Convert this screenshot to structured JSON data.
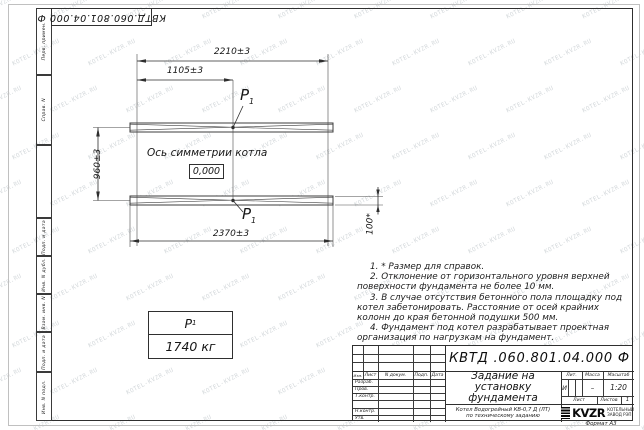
{
  "stamps": {
    "top_left_doc_number": "КВТД.060.801.04.000  Ф"
  },
  "left_strip": {
    "items": [
      {
        "label": "Перв. примен."
      },
      {
        "label": "Справ. N"
      },
      {
        "label": ""
      },
      {
        "label": "Подп. и дата"
      },
      {
        "label": "Инв. N дубл."
      },
      {
        "label": "Взам. инв. N"
      },
      {
        "label": "Подп. и дата"
      },
      {
        "label": "Инв. N подл."
      }
    ]
  },
  "drawing": {
    "dims": {
      "top": "2210±3",
      "top_half": "1105±3",
      "left": "960±3",
      "bottom": "2370±3",
      "right": "100*"
    },
    "axis_label": "Ось симметрии котла",
    "level_mark": "0,000",
    "load_point": {
      "name": "P",
      "index": "1"
    },
    "load_table": {
      "name": "P",
      "index": "1",
      "mass": "1740 кг"
    }
  },
  "notes": {
    "items": [
      "1. * Размер для справок.",
      "2. Отклонение от горизонтального уровня верхней поверхности фундамента не более 10 мм.",
      "3. В случае отсутствия бетонного пола площадку под котел забетонировать. Расстояние от осей крайних колонн до края бетонной подушки 500 мм.",
      "4. Фундамент под котел разрабатывает проектная организация по нагрузкам на фундамент."
    ]
  },
  "title_block": {
    "doc_number": "КВТД .060.801.04.000   Ф",
    "title": "Задание на установку фундамента",
    "product_line1": "Котел Водогрейный КВ-0,7 Д (ЛТ)",
    "product_line2": "по техническому заданию",
    "headers": {
      "izm": "Изм.",
      "list": "Лист",
      "doc_no": "N докум.",
      "podp": "Подп.",
      "date": "Дата",
      "lit": "Лит.",
      "mass": "Масса",
      "scale": "Масштаб",
      "sheet": "Лист",
      "sheets": "Листов"
    },
    "row_labels": [
      {
        "label": "Разраб."
      },
      {
        "label": "Пров."
      },
      {
        "label": "Т.контр."
      },
      {
        "label": ""
      },
      {
        "label": "Н.контр."
      },
      {
        "label": "Утв."
      }
    ],
    "values": {
      "lit": "И",
      "mass": "–",
      "scale": "1:20",
      "sheets": "1"
    },
    "logo": {
      "name": "KVZR",
      "caption1": "КОТЕЛЬНЫЙ",
      "caption2": "ЗАВОД РЭП"
    }
  },
  "footer": {
    "format": "Формат А3"
  },
  "watermark": {
    "text": "KOTEL-KVZR.RU"
  }
}
